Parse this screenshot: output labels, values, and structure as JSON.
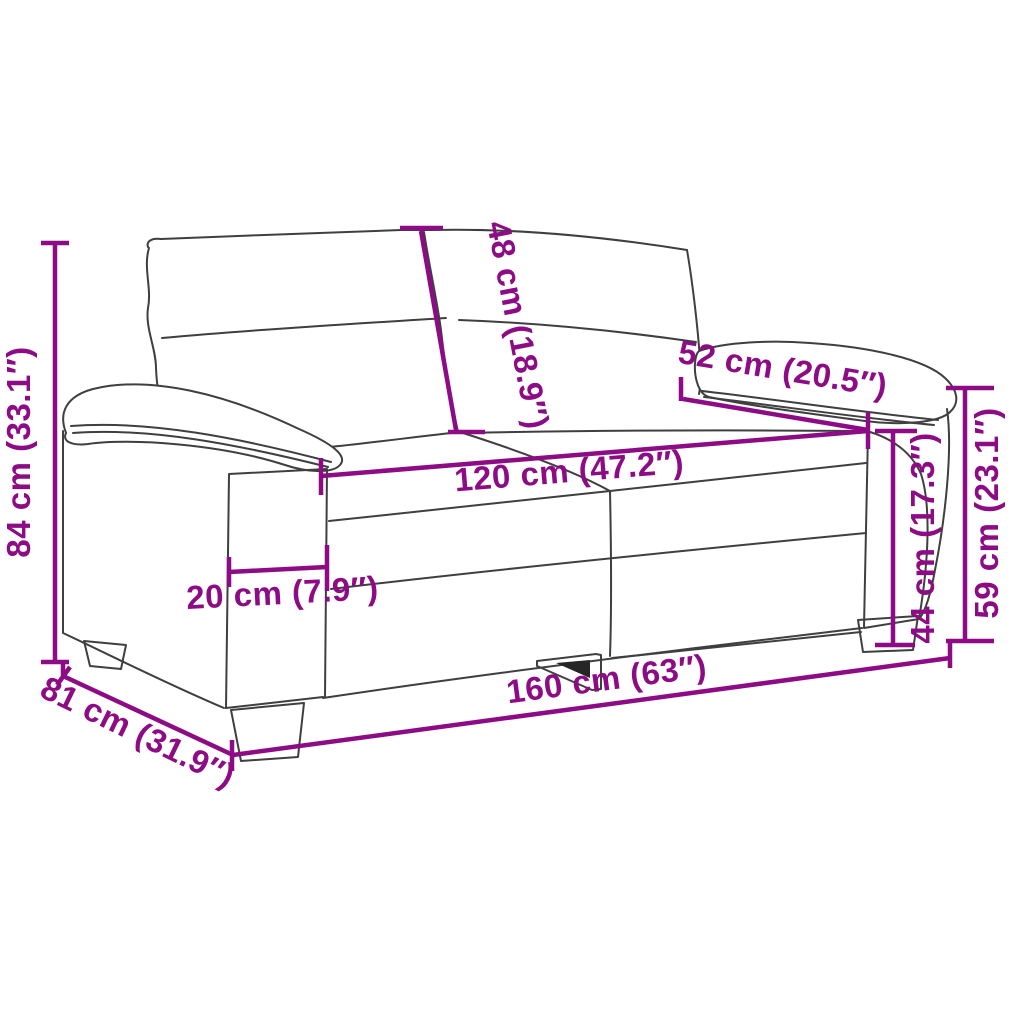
{
  "diagram": {
    "type": "product-dimension-diagram",
    "subject": "2-seater sofa line drawing with measurements",
    "colors": {
      "dimension": "#8d0b85",
      "artwork": "#3f3f3f",
      "background": "#ffffff"
    },
    "dimensions": [
      {
        "id": "overall-height",
        "label": "84 cm (33.1″)",
        "value_cm": 84,
        "value_in": 33.1
      },
      {
        "id": "backrest-height",
        "label": "48 cm (18.9″)",
        "value_cm": 48,
        "value_in": 18.9
      },
      {
        "id": "armrest-depth",
        "label": "52 cm (20.5″)",
        "value_cm": 52,
        "value_in": 20.5
      },
      {
        "id": "seat-width",
        "label": "120 cm (47.2″)",
        "value_cm": 120,
        "value_in": 47.2
      },
      {
        "id": "armrest-width",
        "label": "20 cm (7.9″)",
        "value_cm": 20,
        "value_in": 7.9
      },
      {
        "id": "seat-height",
        "label": "44 cm (17.3″)",
        "value_cm": 44,
        "value_in": 17.3
      },
      {
        "id": "armrest-height",
        "label": "59 cm (23.1″)",
        "value_cm": 59,
        "value_in": 23.1
      },
      {
        "id": "overall-width",
        "label": "160 cm (63″)",
        "value_cm": 160,
        "value_in": 63
      },
      {
        "id": "overall-depth",
        "label": "81 cm (31.9″)",
        "value_cm": 81,
        "value_in": 31.9
      }
    ]
  }
}
